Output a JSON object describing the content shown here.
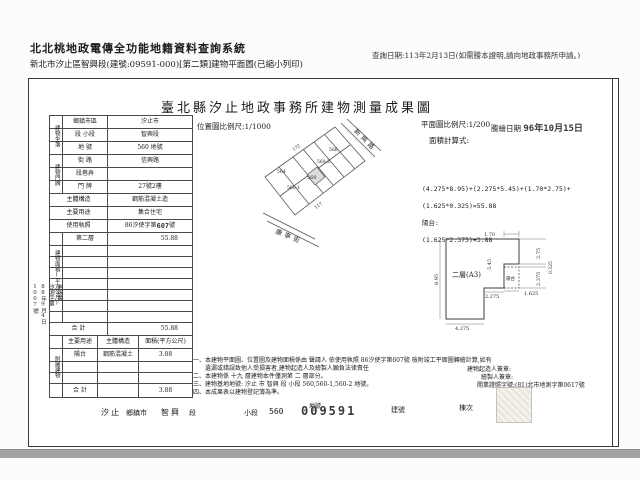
{
  "header": {
    "system_title": "北北桃地政電傳全功能地籍資料查詢系統",
    "subtitle": "新北市汐止區智興段(建號:09591-000)[第二類]建物平面圖(已縮小列印)",
    "query_date": "查詢日期:113年2月13日(如需謄本證明,請向地政事務所申請。)"
  },
  "doc": {
    "title": "臺北縣汐止地政事務所建物測量成果圖",
    "location_scale": "位置圖比例尺:1/1000",
    "plan_scale": "平面圖比例尺:1/200",
    "area_calc_label": "面積計算式:",
    "trace_label": "謄繪日期",
    "trace_stamp": "96年10月15日"
  },
  "building": {
    "group_situs": "建物坐落",
    "group_door": "建物門牌",
    "group_area": "建物面積(平方公尺)",
    "group_annex": "附屬建物",
    "rows": {
      "district_label": "鄉鎮市區",
      "district": "汐止市",
      "section_label": "段 小段",
      "section": "智興段",
      "parcel_label": "地 號",
      "parcel": "560 地號",
      "street_label": "街 路",
      "street": "信興路",
      "lane_label": "段巷弄",
      "lane": "",
      "door_label": "門 牌",
      "door": "27號2樓",
      "structure_label": "主體構造",
      "structure": "鋼筋混凝土造",
      "use_label": "主要用途",
      "use": "集合住宅",
      "license_label": "使用執照",
      "license_prefix": "86汐使字第",
      "license_stamp": "607",
      "license_suffix": "號",
      "floor2_label": "第二層",
      "floor2_area": "55.88",
      "total_label": "合 計",
      "total": "55.88"
    },
    "annex": {
      "h1": "主要用途",
      "h2": "主體構造",
      "h3": "面積(平方公尺)",
      "use": "陽台",
      "structure": "鋼筋混凝土",
      "area": "3.88",
      "total_label": "合 計",
      "total": "3.88"
    }
  },
  "receipt": {
    "l1": "申請書",
    "l2": "汐測字第",
    "l3": "88年9月4日",
    "l4": "1007號"
  },
  "map": {
    "road_right": "新興路",
    "road_bottom": "康寧街",
    "p1": "560",
    "p2": "560-1",
    "p3": "560-2",
    "p4": "564",
    "p5": "566",
    "d1": "172",
    "d2": "117"
  },
  "calc": {
    "l1": "(4.275*8.95)+(2.275*5.45)+(1.70*2.75)+",
    "l2": "(1.625*0.325)=55.88",
    "l3": "陽台:",
    "l4": "(1.625*2.375)=3.88"
  },
  "plan": {
    "room": "二層(A3)",
    "balcony": "陽台",
    "dim_top": "1.70",
    "dim_left": "8.95",
    "dim_inner": "5.45",
    "dim_r1": "2.75",
    "dim_r2": "0.325",
    "dim_r3": "2.375",
    "dim_b1": "2.275",
    "dim_b2": "1.625",
    "dim_bottom": "4.275"
  },
  "notes": {
    "n1": "一、本建物平面圖、位置圖及建物面積係由 聲請人 依使用執照 86汐使字第607號 檢附竣工平面圖轉繪計算,如有",
    "n1b": "遺漏或錯誤致他人受損害者,建物起造人及繪製人願負法律責任",
    "n2": "二、本建物係 十九 層建物本件僅測第 二 層部分。",
    "n3": "三、建物基地地號: 汐止 市 智興 段 小段 560,560-1,560-2 地號。",
    "n4": "四、本成果表以建物登記簿為準。",
    "builder": "建物起造人簽章:",
    "drafter": "繪製人簽章:",
    "license": "開業證照字號:(81)北市地測字第0617號"
  },
  "strip": {
    "town": "汐止",
    "town_label": "鄉鎮市",
    "section": "智興",
    "section_label": "段",
    "subsection_label": "小段",
    "parcel": "560",
    "parcel_label": "地號",
    "stamp": "009591",
    "bno_label": "建號",
    "unit_label": "棟次"
  }
}
